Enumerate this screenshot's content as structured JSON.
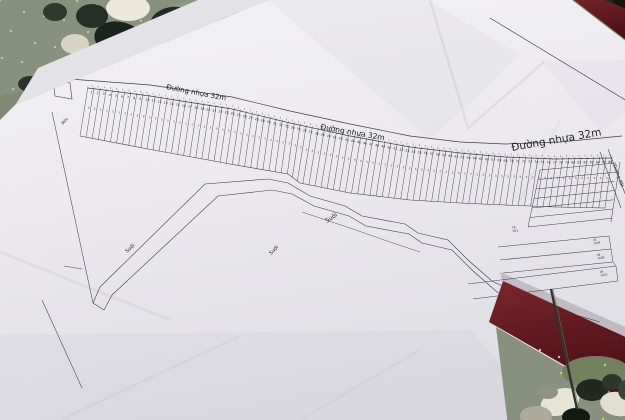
{
  "colors": {
    "floor_moss": "#87917d",
    "floor_dots": "#d5dc5f",
    "paper_light": "#f3f2f5",
    "paper_mid": "#eceaef",
    "paper_dark": "#dfdee4",
    "undersheet": "#e3e2e6",
    "ink": "#3c3e47",
    "ink_text": "#23242b",
    "red_frame": "#5d181d",
    "red_frame_dark": "#451013",
    "red_frame_light": "#7a272c",
    "stem": "#2e342c"
  },
  "labels": {
    "road": [
      {
        "text": "Đường nhựa 32m",
        "x": 166,
        "y": 89,
        "rot": 11,
        "size": 7
      },
      {
        "text": "Đường nhựa 32m",
        "x": 320,
        "y": 129,
        "rot": 10,
        "size": 7.5
      },
      {
        "text": "Đường nhựa 32m",
        "x": 512,
        "y": 151,
        "rot": -10,
        "size": 10.5
      }
    ],
    "stream": [
      {
        "text": "Suối",
        "x": 127,
        "y": 253,
        "rot": -42,
        "size": 5
      },
      {
        "text": "Suối",
        "x": 271,
        "y": 255,
        "rot": -44,
        "size": 5
      },
      {
        "text": "Suối",
        "x": 327,
        "y": 223,
        "rot": -34,
        "size": 6
      },
      {
        "text": "Suối",
        "x": 498,
        "y": 302,
        "rot": -12,
        "size": 6.5
      }
    ],
    "dirt_road": {
      "text": "Đường đất",
      "x": 613,
      "y": 165,
      "rot": 70,
      "size": 4.5
    },
    "marker": {
      "text": "Mốc",
      "x": 63,
      "y": 125,
      "rot": -48,
      "size": 4
    },
    "strip_labels": [
      {
        "lines": [
          "78",
          "701"
        ],
        "x": 512,
        "y": 229,
        "rot": -10,
        "size": 3
      },
      {
        "lines": [
          "93",
          "1004"
        ],
        "x": 593,
        "y": 241,
        "rot": -8,
        "size": 2.8
      },
      {
        "lines": [
          "94",
          "1008"
        ],
        "x": 597,
        "y": 256,
        "rot": -8,
        "size": 2.8
      },
      {
        "lines": [
          "95",
          "1010"
        ],
        "x": 600,
        "y": 273,
        "rot": -8,
        "size": 2.8
      }
    ],
    "lot_width_mark": "5"
  },
  "map_data": {
    "type": "cadastral-plan",
    "lot_band": {
      "count": 86,
      "start_number": 1,
      "top": [
        [
          88,
          88
        ],
        [
          150,
          96
        ],
        [
          232,
          109
        ],
        [
          290,
          123
        ],
        [
          350,
          136
        ],
        [
          410,
          147
        ],
        [
          460,
          153
        ],
        [
          505,
          157
        ],
        [
          555,
          159
        ],
        [
          612,
          158
        ]
      ],
      "bottom": [
        [
          80,
          136
        ],
        [
          148,
          149
        ],
        [
          230,
          164
        ],
        [
          288,
          174
        ],
        [
          300,
          183
        ],
        [
          350,
          193
        ],
        [
          410,
          200
        ],
        [
          460,
          203
        ],
        [
          505,
          205
        ],
        [
          555,
          207
        ],
        [
          605,
          208
        ]
      ]
    },
    "road_upper": [
      [
        56,
        78
      ],
      [
        150,
        85
      ],
      [
        232,
        97
      ],
      [
        290,
        111
      ],
      [
        350,
        124
      ],
      [
        410,
        136
      ],
      [
        460,
        142
      ],
      [
        505,
        144
      ],
      [
        560,
        142
      ],
      [
        622,
        136
      ]
    ],
    "road_start_box": [
      [
        53,
        80
      ],
      [
        70,
        83
      ],
      [
        72,
        99
      ],
      [
        55,
        96
      ]
    ],
    "dirt_road_lines": [
      [
        [
          600,
          152
        ],
        [
          621,
          208
        ]
      ],
      [
        [
          608,
          149
        ],
        [
          629,
          204
        ]
      ]
    ],
    "right_border": [
      [
        490,
        18
      ],
      [
        632,
        104
      ]
    ],
    "left_border": [
      [
        52,
        112
      ],
      [
        93,
        303
      ]
    ],
    "left_border2": [
      [
        42,
        300
      ],
      [
        82,
        388
      ]
    ],
    "left_tick": [
      [
        64,
        266
      ],
      [
        82,
        269
      ]
    ],
    "stream_banks": {
      "a": [
        [
          100,
          287
        ],
        [
          205,
          184
        ],
        [
          268,
          179
        ],
        [
          288,
          183
        ],
        [
          310,
          196
        ],
        [
          345,
          206
        ],
        [
          362,
          216
        ],
        [
          405,
          224
        ],
        [
          418,
          233
        ],
        [
          448,
          240
        ],
        [
          468,
          260
        ],
        [
          492,
          281
        ],
        [
          525,
          297
        ],
        [
          562,
          311
        ],
        [
          600,
          322
        ]
      ],
      "b": [
        [
          112,
          295
        ],
        [
          218,
          196
        ],
        [
          272,
          190
        ],
        [
          292,
          194
        ],
        [
          314,
          206
        ],
        [
          349,
          216
        ],
        [
          366,
          226
        ],
        [
          409,
          234
        ],
        [
          422,
          243
        ],
        [
          452,
          250
        ],
        [
          472,
          270
        ],
        [
          497,
          292
        ],
        [
          530,
          308
        ],
        [
          566,
          322
        ],
        [
          600,
          333
        ]
      ]
    },
    "stream_hook": [
      [
        100,
        287
      ],
      [
        93,
        303
      ],
      [
        104,
        310
      ],
      [
        112,
        295
      ]
    ],
    "meander": [
      [
        302,
        212
      ],
      [
        350,
        228
      ],
      [
        390,
        242
      ],
      [
        420,
        252
      ]
    ],
    "strips_small": {
      "n": 7,
      "left": [
        540,
        170
      ],
      "right": [
        616,
        163
      ],
      "d_left": [
        -2,
        9.5
      ],
      "d_right": [
        -0.6,
        9.2
      ]
    },
    "strips_small_left_edge": [
      [
        540,
        170
      ],
      [
        528,
        227
      ]
    ],
    "strips_small_right_edge": [
      [
        620,
        162
      ],
      [
        611,
        222
      ]
    ],
    "strips_large": [
      [
        [
          498,
          247
        ],
        [
          609,
          236
        ]
      ],
      [
        [
          500,
          260
        ],
        [
          611,
          249
        ]
      ],
      [
        [
          503,
          273
        ],
        [
          613,
          262
        ]
      ],
      [
        [
          468,
          284
        ],
        [
          616,
          266
        ]
      ],
      [
        [
          473,
          299
        ],
        [
          618,
          281
        ]
      ]
    ],
    "strips_large_right_edge": [
      [
        609,
        236
      ],
      [
        611,
        249
      ],
      [
        613,
        262
      ],
      [
        616,
        266
      ],
      [
        618,
        281
      ]
    ]
  },
  "photo": {
    "paper_polygon": [
      [
        16,
        104
      ],
      [
        268,
        0
      ],
      [
        572,
        0
      ],
      [
        632,
        46
      ],
      [
        632,
        330
      ],
      [
        560,
        426
      ],
      [
        0,
        426
      ],
      [
        0,
        120
      ]
    ],
    "undersheet_polygon": [
      [
        38,
        68
      ],
      [
        198,
        0
      ],
      [
        268,
        0
      ],
      [
        16,
        104
      ]
    ],
    "red_band_top": [
      [
        566,
        -6
      ],
      [
        634,
        46
      ],
      [
        634,
        12
      ],
      [
        590,
        -6
      ]
    ],
    "red_band_bottom": [
      [
        503,
        281
      ],
      [
        632,
        340
      ],
      [
        632,
        404
      ],
      [
        489,
        322
      ]
    ],
    "band_shadow": [
      [
        500,
        272
      ],
      [
        632,
        330
      ],
      [
        632,
        342
      ],
      [
        503,
        283
      ]
    ],
    "floor_br": [
      [
        496,
        327
      ],
      [
        632,
        406
      ],
      [
        632,
        426
      ],
      [
        508,
        426
      ]
    ],
    "stick": {
      "from": [
        551,
        289
      ],
      "to": [
        577,
        409
      ]
    },
    "floor_patches": [
      [
        40,
        150,
        90,
        60,
        "#77826b",
        0.5
      ],
      [
        300,
        30,
        150,
        45,
        "#97a089",
        0.45
      ],
      [
        560,
        30,
        60,
        35,
        "#717d64",
        0.5
      ],
      [
        580,
        390,
        70,
        45,
        "#6d7a60",
        0.55
      ],
      [
        500,
        370,
        40,
        25,
        "#7c886d",
        0.5
      ]
    ],
    "dot_regions": [
      {
        "x": 0,
        "y": 0,
        "w": 360,
        "h": 108,
        "n": 62,
        "sa": 53,
        "sb": 97
      },
      {
        "x": 480,
        "y": 328,
        "w": 150,
        "h": 95,
        "n": 30,
        "sa": 61,
        "sb": 43
      }
    ],
    "pebbles": [
      [
        120,
        40,
        26,
        18,
        15,
        "#1b231d"
      ],
      [
        172,
        22,
        22,
        15,
        -10,
        "#232b24"
      ],
      [
        205,
        48,
        18,
        13,
        30,
        "#141b16"
      ],
      [
        92,
        16,
        16,
        12,
        0,
        "#262e27"
      ],
      [
        228,
        16,
        14,
        10,
        0,
        "#1d251f"
      ],
      [
        148,
        58,
        26,
        17,
        5,
        "#e7e3d3"
      ],
      [
        128,
        8,
        22,
        13,
        0,
        "#ece8da"
      ],
      [
        243,
        38,
        18,
        12,
        -15,
        "#ded9c8"
      ],
      [
        185,
        64,
        16,
        11,
        0,
        "#cfcaba"
      ],
      [
        75,
        44,
        14,
        10,
        0,
        "#d8d4c4"
      ],
      [
        250,
        8,
        13,
        9,
        0,
        "#b9b5a6"
      ],
      [
        104,
        66,
        13,
        9,
        0,
        "#99988a"
      ],
      [
        30,
        84,
        12,
        8,
        0,
        "#2a332b"
      ],
      [
        55,
        12,
        12,
        9,
        0,
        "#31392f"
      ],
      [
        395,
        6,
        26,
        9,
        0,
        "#dfdccc"
      ],
      [
        432,
        5,
        20,
        8,
        0,
        "#d2cfc0"
      ],
      [
        462,
        4,
        13,
        6,
        0,
        "#c5c3b4"
      ],
      [
        350,
        4,
        16,
        7,
        0,
        "#aab3a0"
      ],
      [
        616,
        7,
        16,
        11,
        0,
        "#11170f"
      ],
      [
        603,
        2,
        10,
        7,
        0,
        "#20271e"
      ],
      [
        625,
        22,
        9,
        7,
        0,
        "#2a2f26"
      ]
    ],
    "pebbles_br": [
      [
        560,
        402,
        20,
        13,
        -20,
        "#e8e4d4"
      ],
      [
        592,
        390,
        16,
        11,
        0,
        "#20281f"
      ],
      [
        618,
        404,
        18,
        12,
        10,
        "#e3dfcf"
      ],
      [
        536,
        416,
        16,
        10,
        0,
        "#aeab9b"
      ],
      [
        576,
        417,
        14,
        9,
        0,
        "#141a12"
      ],
      [
        612,
        382,
        10,
        8,
        0,
        "#2e362b"
      ],
      [
        548,
        392,
        10,
        7,
        0,
        "#8f9383"
      ],
      [
        626,
        390,
        8,
        10,
        0,
        "#3a4436"
      ]
    ],
    "wrinkle_polys": [
      {
        "pts": [
          [
            268,
            0
          ],
          [
            430,
            140
          ],
          [
            520,
            55
          ],
          [
            428,
            0
          ]
        ],
        "fill": "rgba(130,130,148,0.05)"
      },
      {
        "pts": [
          [
            0,
            335
          ],
          [
            470,
            330
          ],
          [
            556,
            424
          ],
          [
            0,
            424
          ]
        ],
        "fill": "rgba(115,115,132,0.05)"
      },
      {
        "pts": [
          [
            540,
            60
          ],
          [
            600,
            130
          ],
          [
            632,
            110
          ],
          [
            632,
            60
          ]
        ],
        "fill": "rgba(130,130,148,0.04)"
      }
    ],
    "wrinkle_lines": [
      {
        "pts": [
          [
            430,
            0
          ],
          [
            468,
            128
          ],
          [
            544,
            62
          ]
        ],
        "o": 0.1,
        "w": 2.5
      },
      {
        "pts": [
          [
            0,
            252
          ],
          [
            170,
            320
          ]
        ],
        "o": 0.07,
        "w": 3
      },
      {
        "pts": [
          [
            60,
            420
          ],
          [
            240,
            336
          ]
        ],
        "o": 0.06,
        "w": 2.5
      },
      {
        "pts": [
          [
            300,
            420
          ],
          [
            420,
            350
          ]
        ],
        "o": 0.05,
        "w": 2
      },
      {
        "pts": [
          [
            560,
            120
          ],
          [
            520,
            200
          ]
        ],
        "o": 0.06,
        "w": 2
      }
    ]
  }
}
